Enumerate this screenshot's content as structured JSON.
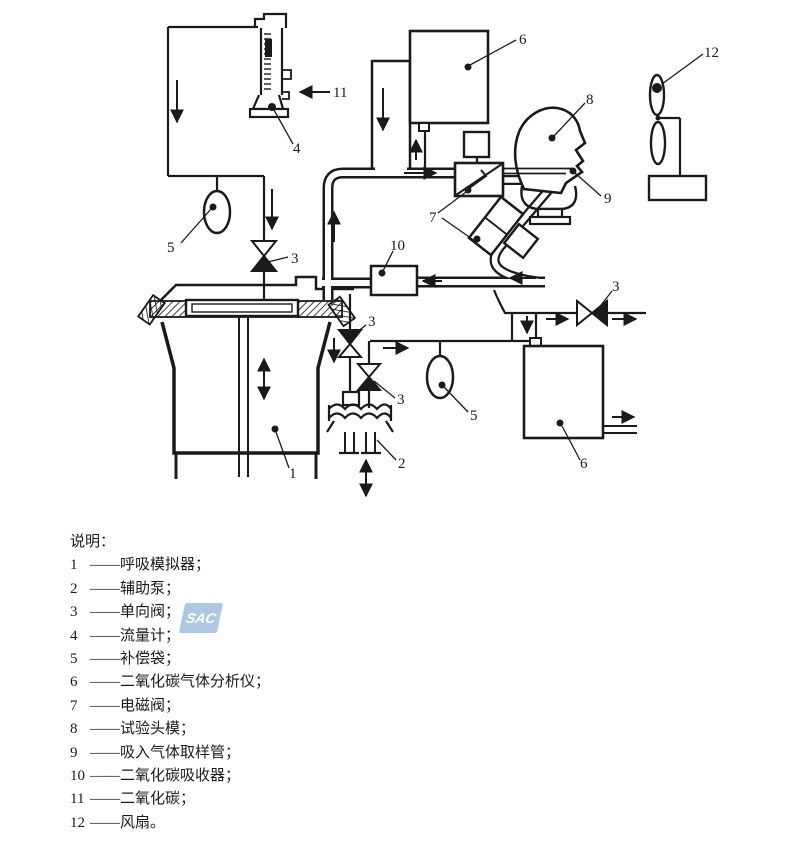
{
  "watermark": "SAC",
  "legend": {
    "heading": "说明：",
    "items": [
      {
        "num": "1",
        "label": "——呼吸模拟器；"
      },
      {
        "num": "2",
        "label": "——辅助泵；"
      },
      {
        "num": "3",
        "label": "——单向阀；"
      },
      {
        "num": "4",
        "label": "——流量计；"
      },
      {
        "num": "5",
        "label": "——补偿袋；"
      },
      {
        "num": "6",
        "label": "——二氧化碳气体分析仪；"
      },
      {
        "num": "7",
        "label": "——电磁阀；"
      },
      {
        "num": "8",
        "label": "——试验头模；"
      },
      {
        "num": "9",
        "label": "——吸入气体取样管；"
      },
      {
        "num": "10",
        "label": "——二氧化碳吸收器；"
      },
      {
        "num": "11",
        "label": "——二氧化碳；"
      },
      {
        "num": "12",
        "label": "——风扇。"
      }
    ]
  },
  "diagram": {
    "labels": [
      "6",
      "8",
      "12",
      "11",
      "4",
      "9",
      "7",
      "5",
      "3",
      "10",
      "3",
      "3",
      "3",
      "5",
      "1",
      "2",
      "6"
    ],
    "line_color": "#1a1a1a",
    "watermark_color": "#aec7e2"
  }
}
